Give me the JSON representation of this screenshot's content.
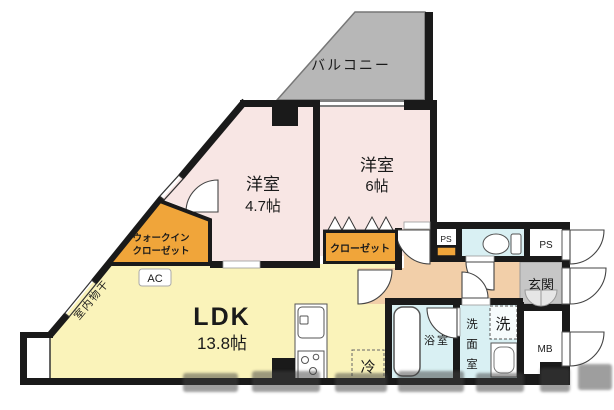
{
  "plan": {
    "balcony_label": "バルコニー",
    "bedroom6": {
      "name": "洋室",
      "size": "6帖"
    },
    "bedroom47": {
      "name": "洋室",
      "size": "4.7帖"
    },
    "wic": {
      "line1": "ウォークイン",
      "line2": "クローゼット"
    },
    "closet_label": "クローゼット",
    "ldk": {
      "name": "LDK",
      "size": "13.8帖"
    },
    "ac_label": "AC",
    "indoor_drying_label": "室内物干",
    "bathroom_label": "浴室",
    "washroom": {
      "c1": "洗",
      "c2": "面",
      "c3": "室"
    },
    "washer_label": "洗",
    "fridge_label": "冷",
    "entrance_label": "玄関",
    "ps_left_label": "PS",
    "ps_right_label": "PS",
    "meter_box_label": "MB"
  },
  "colors": {
    "wall": "#1a1a1a",
    "bedroom_pink": "#f8e6e4",
    "ldk_yellow": "#faf3ba",
    "closet_orange": "#f0a53a",
    "corridor_tan": "#f2cfa9",
    "wet_cyan": "#d9f0f3",
    "balcony_gray": "#b7b7b7",
    "entrance_gray": "#c6c6c6"
  }
}
